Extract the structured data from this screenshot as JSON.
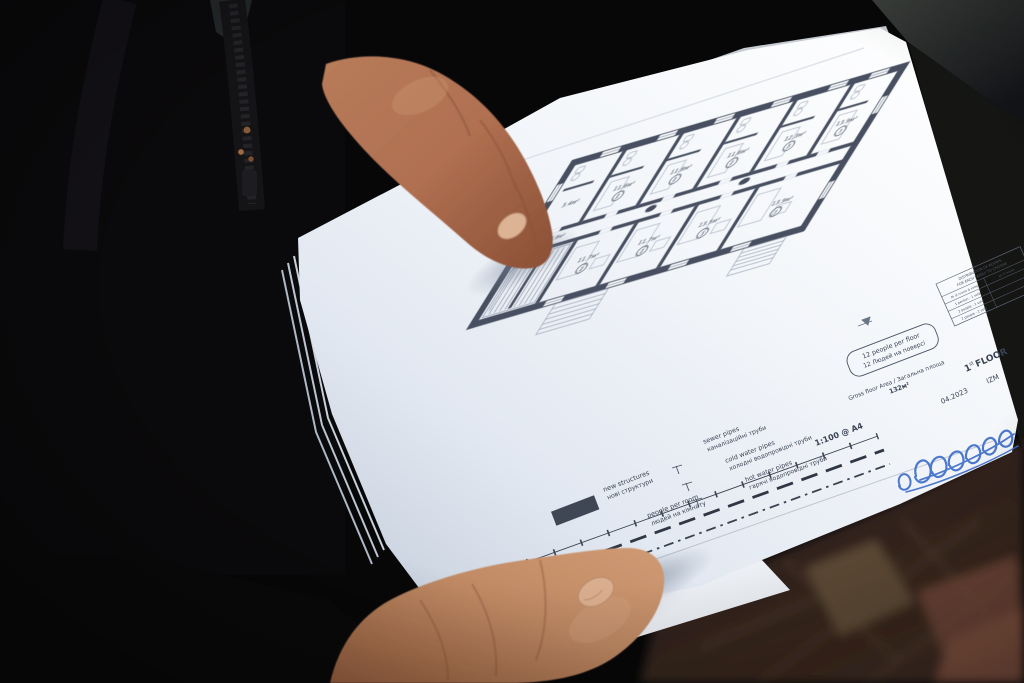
{
  "plan": {
    "rooms": [
      {
        "area": "3.4м²",
        "occupancy": ""
      },
      {
        "area": "11.6м²",
        "occupancy": "2"
      },
      {
        "area": "11.8м²",
        "occupancy": "2"
      },
      {
        "area": "11.6м²",
        "occupancy": "2"
      },
      {
        "area": "12.3м²",
        "occupancy": "3"
      },
      {
        "area": "13.9м²",
        "occupancy": "3"
      },
      {
        "area": "16.9м²",
        "occupancy": ""
      },
      {
        "area": "11.7м²",
        "occupancy": "2"
      },
      {
        "area": "11.7м²",
        "occupancy": "2"
      },
      {
        "area": "13.5м²",
        "occupancy": "3"
      },
      {
        "area": "13.9м²",
        "occupancy": "3"
      }
    ],
    "notes": {
      "people_per_floor_en": "12 people per floor",
      "people_per_floor_uk": "12 Людей на поверсі",
      "gross_area_label": "Gross floor Area / Загальна площа",
      "gross_area_value": "132м²"
    },
    "legend": {
      "new_structures_en": "new structures",
      "new_structures_uk": "нові структури",
      "people_per_room_en": "people per room",
      "people_per_room_uk": "людей на кімнату",
      "sewer_en": "sewer pipes",
      "sewer_uk": "каналізаційні труби",
      "cold_en": "cold water pipes",
      "cold_uk": "холодні водопровідні труби",
      "hot_en": "hot water pipes",
      "hot_uk": "гарячі водопровідні труби"
    },
    "scale": "1:100 @ A4",
    "title_block": {
      "header_1": "DISTRIBUTION OF ROOMS",
      "header_2": "FOR EACH FAMILY TO CHOOSE",
      "col_1": "№ of rooms & sofas",
      "col_2": "№ of house",
      "rows": [
        "1 person - 1 sofa",
        "2 people - 1 sofa",
        "2 people - 2 sofa"
      ]
    },
    "floor_num": "1",
    "floor_sup": "st",
    "floor_word": "FLOOR",
    "date": "04.2023",
    "revision": "IZM"
  },
  "colors": {
    "ink": "#464f60",
    "signature": "#3f6fca",
    "paper": "#f4f7fb"
  }
}
